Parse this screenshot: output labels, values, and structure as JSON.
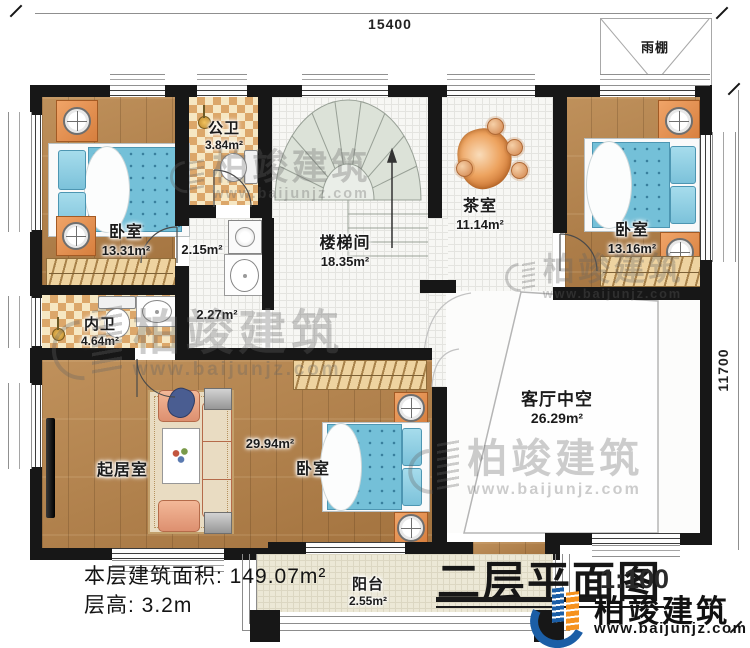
{
  "meta": {
    "drawing_title": "二层平面图",
    "scale": "1:100"
  },
  "brand": {
    "name": "柏竣建筑",
    "url": "www.baijunjz.com"
  },
  "dimensions": {
    "top": "15400",
    "right": "11700"
  },
  "info": {
    "floor_area_label": "本层建筑面积: 149.07m²",
    "floor_height_label": "层高: 3.2m"
  },
  "rooms": {
    "bedroom_top_left": {
      "name": "卧室",
      "area": "13.31m²"
    },
    "public_bath": {
      "name": "公卫",
      "area": "3.84m²"
    },
    "laundry_nook": {
      "area": "2.15m²"
    },
    "hallway": {
      "area": "2.27m²"
    },
    "stairwell": {
      "name": "楼梯间",
      "area": "18.35m²"
    },
    "tea_room": {
      "name": "茶室",
      "area": "11.14m²"
    },
    "bedroom_top_right": {
      "name": "卧室",
      "area": "13.16m²"
    },
    "rain_canopy": {
      "name": "雨棚"
    },
    "inner_bath": {
      "name": "内卫",
      "area": "4.64m²"
    },
    "living_room": {
      "name": "起居室"
    },
    "open_living_area": {
      "area": "29.94m²"
    },
    "bedroom_bottom": {
      "name": "卧室"
    },
    "living_void": {
      "name": "客厅中空",
      "area": "26.29m²"
    },
    "balcony": {
      "name": "阳台",
      "area": "2.55m²"
    }
  },
  "colors": {
    "wall": "#171717",
    "wood": "#b1804a",
    "bath_tile": "#dca76a",
    "mattress": "#74c0d8",
    "stairs": "#dce2d8",
    "logo_blue": "#1b5ea6",
    "logo_orange": "#f6921e"
  }
}
